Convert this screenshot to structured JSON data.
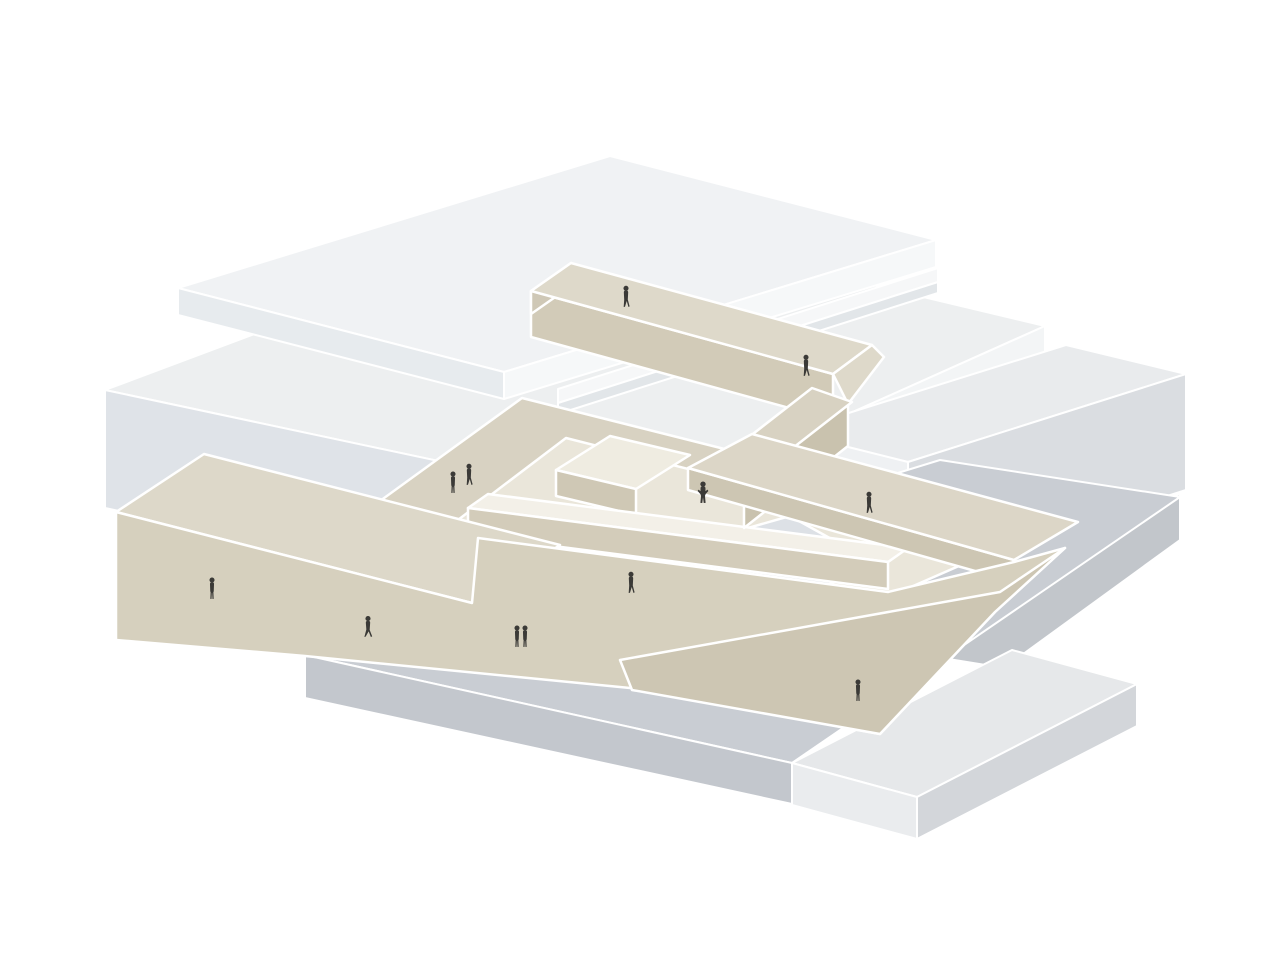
{
  "scene": {
    "description": "Axonometric architectural diagram: beige sloping public plaza and zig-zag rooftop walkways threading between white and gray building slabs, populated with small human silhouettes.",
    "style": "flat axonometric illustration with white seam lines",
    "masses": [
      {
        "name": "floating-roof-slab",
        "material": "white"
      },
      {
        "name": "background-building-slab",
        "material": "light-gray"
      },
      {
        "name": "right-building-bar",
        "material": "light-gray"
      },
      {
        "name": "ground-plinth",
        "material": "gray"
      },
      {
        "name": "lower-right-block",
        "material": "light-gray"
      },
      {
        "name": "left-terraced-volume",
        "material": "beige"
      },
      {
        "name": "sloping-public-plaza",
        "material": "beige"
      },
      {
        "name": "courtyard-deck",
        "material": "beige"
      },
      {
        "name": "elevated-bridge-ramp",
        "material": "beige"
      },
      {
        "name": "right-walkway",
        "material": "beige"
      }
    ]
  },
  "palette": {
    "background": "#ffffff",
    "edge": "#ffffff",
    "slab_top": "#edeff0",
    "slab_side": "#dfe3e8",
    "slab_face_bright": "#f3f5f6",
    "roof_top": "#f0f2f4",
    "bar_top": "#e9ebed",
    "bar_front": "#eff1f3",
    "bar_side": "#dadde1",
    "plinth_top": "#c9cdd3",
    "plinth_front": "#c3c7cd",
    "under_slab": "#c2c6cb",
    "beige_roof": "#ddd8c9",
    "beige_slope": "#d6d0be",
    "beige_deck": "#d8d2c2",
    "beige_floor": "#eae6da",
    "beige_wall": "#d3ccba",
    "beige_wall_dark": "#cdc6b3",
    "bridge_top": "#ded9ca",
    "bridge_side": "#d2cbb8",
    "bridge_shadow": "#c9c2ae",
    "walkway_top": "#dcd6c7",
    "parapet_top": "#f3f0e8",
    "lower_court": "#dde1e6",
    "figure": "#3b3a37"
  },
  "figures": [
    {
      "id": 1,
      "x": 626,
      "y": 307,
      "pose": "walk",
      "location": "upper-bridge"
    },
    {
      "id": 2,
      "x": 806,
      "y": 376,
      "pose": "walk",
      "location": "bridge-bend"
    },
    {
      "id": 3,
      "x": 703,
      "y": 503,
      "pose": "arms-up",
      "location": "central-platform"
    },
    {
      "id": 4,
      "x": 453,
      "y": 493,
      "pose": "stand",
      "location": "courtyard-deck"
    },
    {
      "id": 5,
      "x": 469,
      "y": 485,
      "pose": "walk",
      "location": "courtyard-deck"
    },
    {
      "id": 6,
      "x": 869,
      "y": 513,
      "pose": "walk",
      "location": "right-walkway"
    },
    {
      "id": 7,
      "x": 631,
      "y": 593,
      "pose": "walk",
      "location": "plaza-slope"
    },
    {
      "id": 8,
      "x": 212,
      "y": 599,
      "pose": "stand",
      "location": "plaza-slope-west"
    },
    {
      "id": 9,
      "x": 368,
      "y": 637,
      "pose": "walk-wide",
      "location": "plaza-slope-low"
    },
    {
      "id": 10,
      "x": 517,
      "y": 647,
      "pose": "stand",
      "location": "plaza-slope-low"
    },
    {
      "id": 11,
      "x": 525,
      "y": 647,
      "pose": "stand",
      "location": "plaza-slope-low"
    },
    {
      "id": 12,
      "x": 858,
      "y": 701,
      "pose": "stand",
      "location": "plaza-front-wall"
    }
  ],
  "figure_count": 12
}
